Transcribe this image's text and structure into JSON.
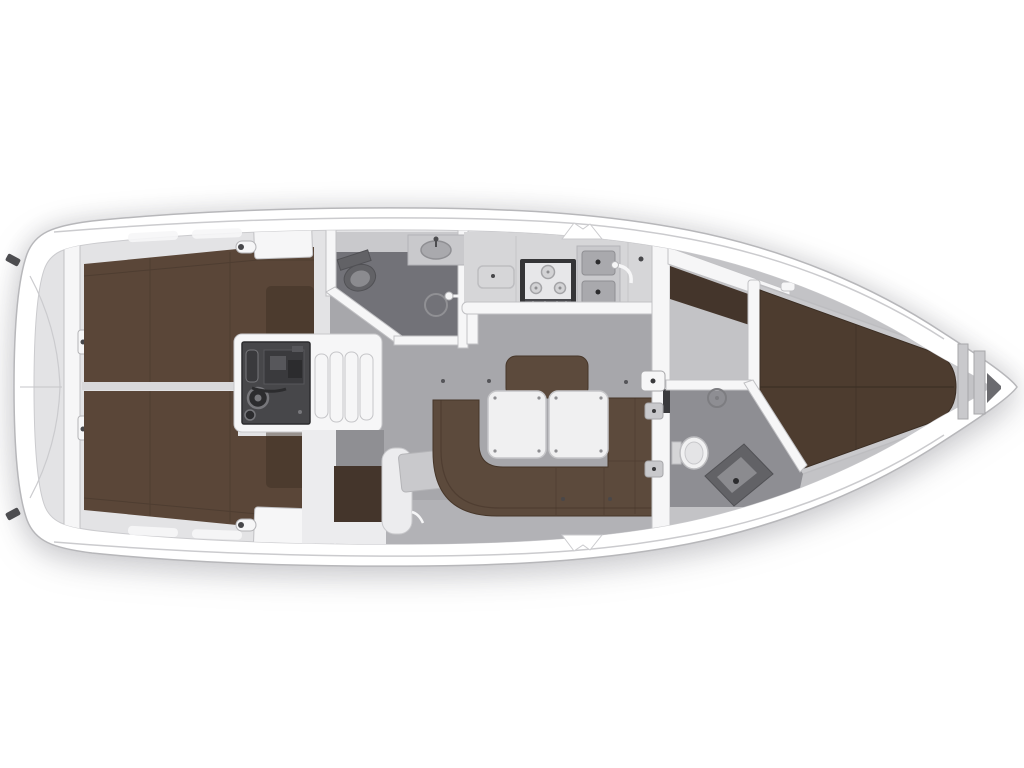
{
  "floorplan": {
    "type": "sailing-yacht-interior-top-view",
    "orientation": {
      "bow": "right",
      "stern": "left"
    },
    "areas": [
      "stern-transom-locker",
      "aft-bulkhead",
      "aft-cabin-port-berth",
      "aft-cabin-starboard-berth",
      "engine-compartment",
      "companionway-steps",
      "aft-head",
      "galley",
      "salon",
      "nav-station",
      "u-shaped-settee",
      "salon-tables",
      "forward-bulkhead",
      "forward-head",
      "forward-cabin-v-berth",
      "anchor-locker"
    ],
    "fixtures": [
      "toilet",
      "washbasin",
      "shower-drain",
      "hand-shower",
      "three-burner-stove",
      "double-sink",
      "faucet",
      "chart-table",
      "engine",
      "step-treads",
      "mooring-cleat",
      "deck-winch",
      "door-leaf",
      "door-latch"
    ],
    "colors": {
      "hull-fill": "#ffffff",
      "hull-stroke": "#b7b7ba",
      "band-line": "#cbcbce",
      "deck-base": "#e3e3e5",
      "divider": "#d8d8da",
      "floor-mid": "#a7a7ab",
      "floor-light": "#c3c3c6",
      "floor-edge": "#bcbcbf",
      "head-floor": "#727278",
      "head-floor-2": "#8e8e93",
      "niche-gray": "#8f8f93",
      "shelf-gray": "#c9c9cc",
      "sink-gray": "#a9a9ad",
      "counter": "#d6d6d8",
      "wall": "#f6f6f7",
      "wall-soft": "#ececee",
      "wall-stroke": "#c1c1c4",
      "bed-brown": "#5a4638",
      "bed-seam": "#45362b",
      "bed-shadow": "#3b2e24",
      "bed-dark": "#4d3c2f",
      "cabinet-brown": "#44352b",
      "sofa-brown": "#5c4a3c",
      "sofa-dark": "#463629",
      "table-white": "#f0f0f1",
      "table-stroke": "#c6c6c9",
      "screw": "#8e8e91",
      "stove-frame": "#353537",
      "stove-top": "#e7e7e9",
      "burner": "#d3d3d5",
      "burner-stroke": "#a4a4a7",
      "knob-strip": "#4a4a4e",
      "knob-light": "#d8d8da",
      "engine-dark": "#47474a",
      "engine-deep": "#2c2c2e",
      "engine-mid": "#3a3a3d",
      "engine-light": "#77777b",
      "engine-accent": "#57575b",
      "porcelain": "#f1f1f2",
      "porcelain-inner": "#e4e4e6",
      "fixture-dark": "#626266",
      "fixture-mid": "#8b8b8f",
      "dot": "#47474a",
      "latch-dot": "#3a3a3c",
      "wedge-dark": "#6b6b6f",
      "cleat-dark": "#4d4d50",
      "metal-stroke": "#a7a7aa",
      "soft-stroke": "#c8c8cb",
      "mid-stroke": "#b4b4b7",
      "dark-stroke": "#515155",
      "drain-stroke": "#7d7d81",
      "shower-stroke": "#909094",
      "seam-line": "#c5c5c8",
      "lid-stroke": "#bdbdc0",
      "hinge-gray": "#d5d5d7"
    }
  }
}
